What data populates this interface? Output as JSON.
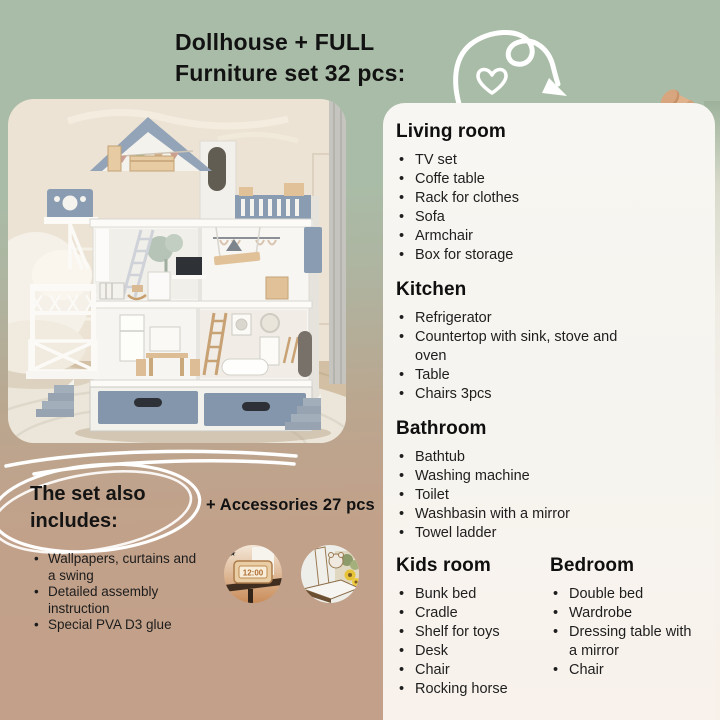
{
  "title": {
    "line1": "Dollhouse + FULL",
    "line2": "Furniture set 32 pcs:"
  },
  "rooms": [
    {
      "name": "Living room",
      "items": [
        "TV set",
        "Coffe table",
        "Rack for clothes",
        "Sofa",
        "Armchair",
        "Box for storage"
      ]
    },
    {
      "name": "Kitchen",
      "items": [
        "Refrigerator",
        "Countertop with sink, stove and oven",
        "Table",
        "Chairs 3pcs"
      ]
    },
    {
      "name": "Bathroom",
      "items": [
        "Bathtub",
        "Washing machine",
        "Toilet",
        "Washbasin with a mirror",
        "Towel ladder"
      ]
    },
    {
      "name": "Kids room",
      "items": [
        "Bunk bed",
        "Cradle",
        "Shelf for toys",
        "Desk",
        "Chair",
        "Rocking horse"
      ]
    },
    {
      "name": "Bedroom",
      "items": [
        "Double bed",
        "Wardrobe",
        "Dressing table with a mirror",
        "Chair"
      ]
    }
  ],
  "includes": {
    "heading": "The set also includes:",
    "items": [
      "Wallpapers, curtains and a swing",
      "Detailed assembly instruction",
      "Special PVA D3 glue"
    ],
    "accessories_label": "+ Accessories 27 pcs"
  },
  "accessory_photos": [
    {
      "name": "wooden-clock-on-shelf",
      "clock_display": "12:00"
    },
    {
      "name": "wooden-shelf-with-flowers"
    }
  ],
  "colors": {
    "background_green": "#a9bca7",
    "background_tan": "#c2a18a",
    "card_bg": "#f7f5f1",
    "roof_blue": "#93a3b8",
    "drawer_blue": "#8496ab",
    "wood": "#dcbd95",
    "text": "#1b1b1b",
    "pushpin_tan": "#d9a87f",
    "doodle_white": "#ffffff"
  }
}
